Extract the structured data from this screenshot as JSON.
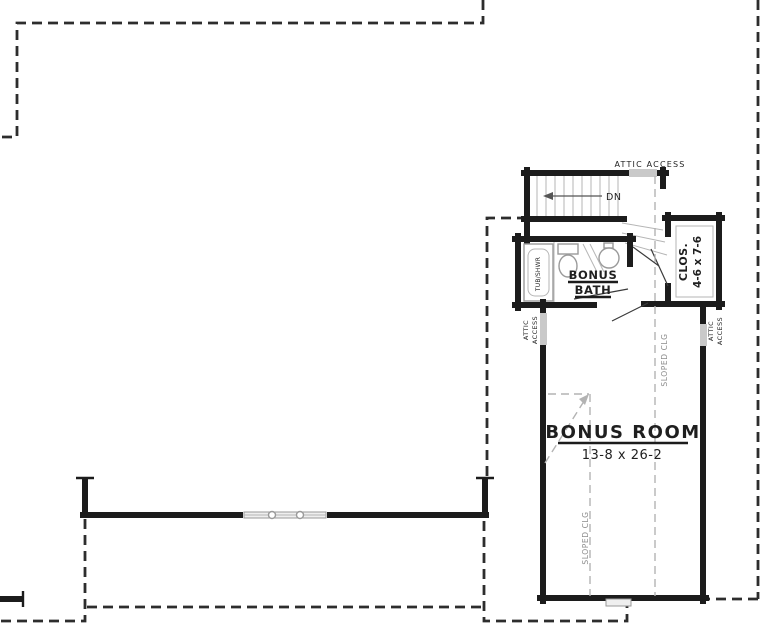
{
  "colors": {
    "background": "#ffffff",
    "wall": "#1c1c1c",
    "roof_dash": "#2d2d2d",
    "light_dash": "#b3b3b3",
    "fixture": "#9a9a9a",
    "access_panel": "#c9c9c9",
    "gray_text": "#8c8c8c",
    "text": "#1f1f1f"
  },
  "labels": {
    "attic_access_top": "ATTIC ACCESS",
    "stairs_direction": "DN",
    "tub_shower": "TUB/SHWR",
    "bath_name_line1": "BONUS",
    "bath_name_line2": "BATH",
    "closet_name": "CLOS.",
    "closet_dimensions": "4-6 x 7-6",
    "attic_left_line1": "ATTIC",
    "attic_left_line2": "ACCESS",
    "attic_right_line1": "ATTIC",
    "attic_right_line2": "ACCESS",
    "sloped_ceiling_upper": "SLOPED CLG",
    "sloped_ceiling_lower": "SLOPED CLG",
    "room_name": "BONUS ROOM",
    "room_dimensions": "13-8 x 26-2"
  }
}
